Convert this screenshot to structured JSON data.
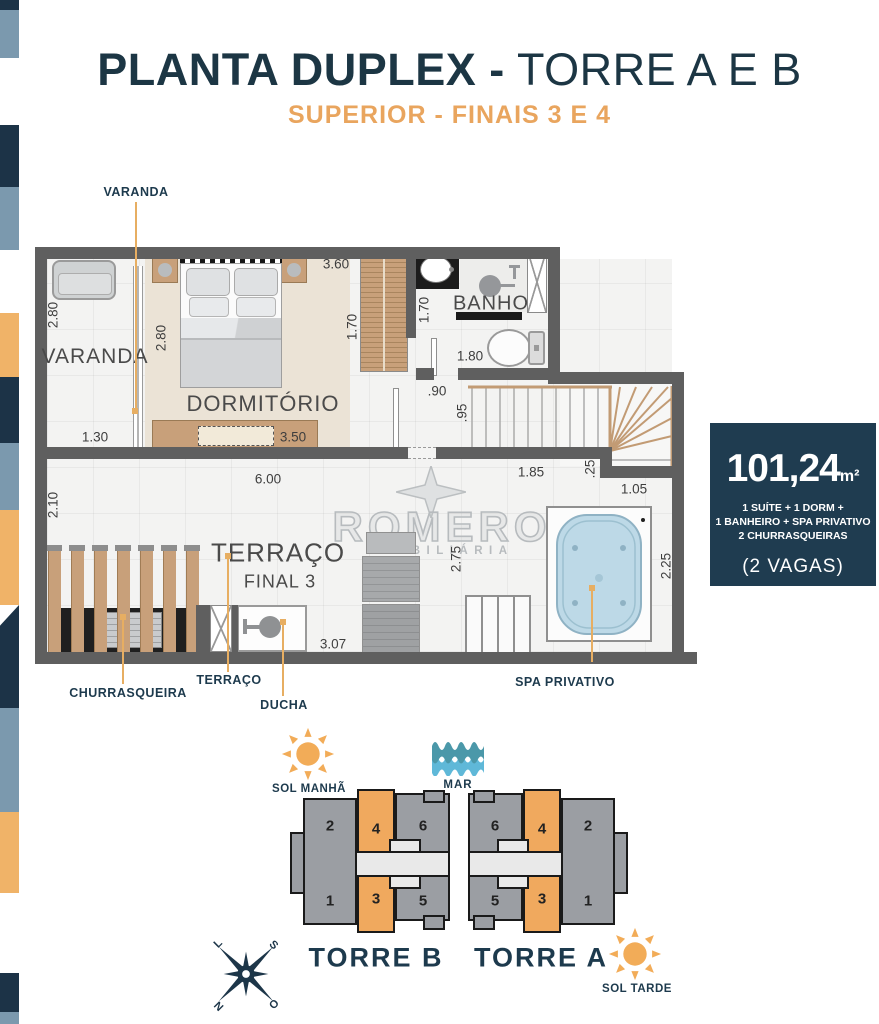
{
  "colors": {
    "navy": "#1d3a4d",
    "orange_accent": "#eba760",
    "blue_gray": "#7b99ae",
    "stripe_orange": "#f0b368",
    "wall_gray": "#5f5f5f",
    "wood": "#c8a07a",
    "spa_blue": "#bdd9e7",
    "tower_gray": "#9b9ea3",
    "tower_orange": "#f0a95e",
    "wave_dark": "#4b98a9",
    "wave_light": "#5fb8d8",
    "leader_orange": "#e7ae62"
  },
  "icons": {
    "sol_manha": "sun-icon",
    "mar": "sea-waves-icon",
    "sol_tarde": "sun-icon",
    "compass": "compass-rose-icon",
    "watermark": "compass-star-icon"
  },
  "title": {
    "main_bold": "PLANTA DUPLEX -",
    "main_light": "TORRE A E B",
    "subtitle": "SUPERIOR - FINAIS 3 E 4"
  },
  "watermark": {
    "brand": "ROMERO",
    "tagline": "IMOBILIÁRIA"
  },
  "plan": {
    "callout_top": "VARANDA",
    "rooms": {
      "varanda": "VARANDA",
      "dormitorio": "DORMITÓRIO",
      "banho": "BANHO",
      "terraco": "TERRAÇO",
      "final": "FINAL 3"
    },
    "callouts": {
      "churrasqueira": "CHURRASQUEIRA",
      "terraco": "TERRAÇO",
      "ducha": "DUCHA",
      "spa": "SPA PRIVATIVO"
    },
    "dims": {
      "varanda_depth": "2.80",
      "varanda_width": "1.30",
      "dorm_depth": "2.80",
      "dorm_width": "3.50",
      "corridor_width": "3.60",
      "closet_depth": "1.70",
      "banho_depth": "1.70",
      "banho_width": "1.80",
      "hall_width": ".90",
      "hall_depth": ".95",
      "terraco_width": "6.00",
      "terraco_depth": "2.10",
      "stairs_width": "1.85",
      "stairs_jog": ".25",
      "spa_offset": "1.05",
      "terraco_mid": "2.75",
      "spa_depth": "2.25",
      "ducha_width": "3.07"
    }
  },
  "info_box": {
    "area": "101,24",
    "area_unit": "m²",
    "line1": "1 SUÍTE + 1 DORM +",
    "line2": "1 BANHEIRO + SPA PRIVATIVO",
    "line3": "2 CHURRASQUEIRAS",
    "parking": "(2 VAGAS)"
  },
  "site": {
    "sol_manha": "SOL MANHÃ",
    "mar": "MAR",
    "sol_tarde": "SOL TARDE",
    "torre_b": {
      "name": "TORRE B",
      "top": [
        "2",
        "4",
        "6"
      ],
      "bottom": [
        "1",
        "3",
        "5"
      ]
    },
    "torre_a": {
      "name": "TORRE A",
      "top": [
        "6",
        "4",
        "2"
      ],
      "bottom": [
        "5",
        "3",
        "1"
      ]
    },
    "compass": {
      "n": "N",
      "s": "S",
      "l": "L",
      "o": "O"
    }
  }
}
